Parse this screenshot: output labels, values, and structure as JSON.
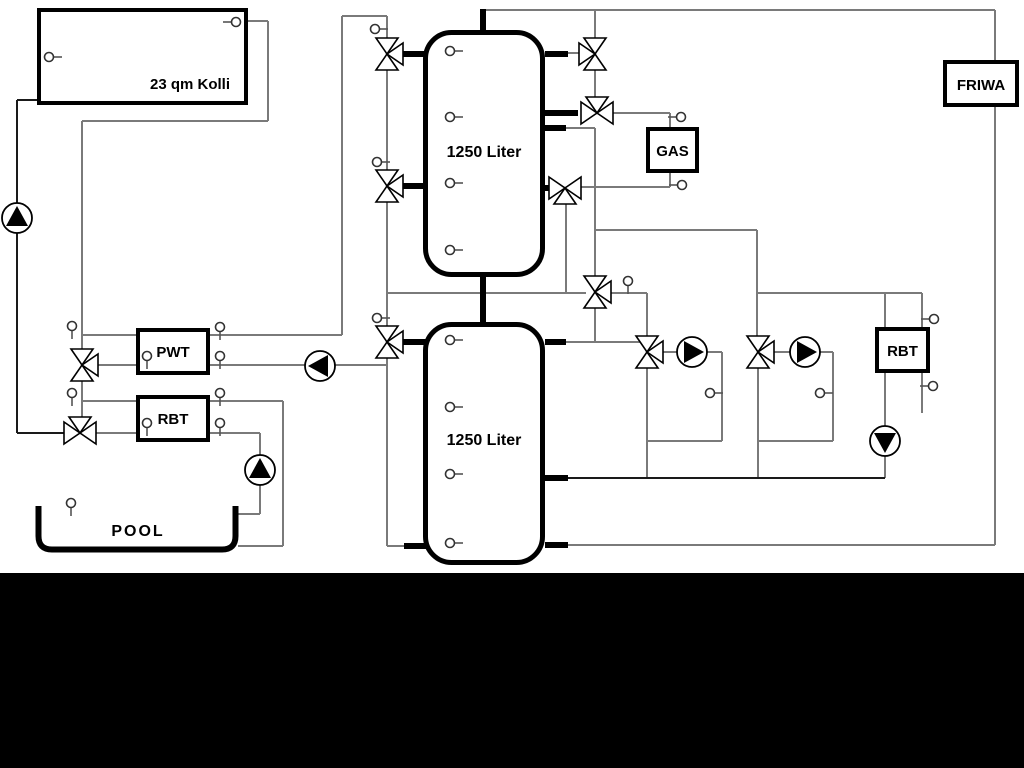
{
  "labels": {
    "collector": "23 qm Kolli",
    "buffer_tank_top": "1250 Liter",
    "buffer_tank_bottom": "1250 Liter",
    "pwt": "PWT",
    "rbt_left": "RBT",
    "pool": "POOL",
    "gas": "GAS",
    "friwa": "FRIWA",
    "rbt_right": "RBT"
  },
  "colors": {
    "background": "#ffffff",
    "pipe_gray": "#7a7a7a",
    "pipe_black": "#1a1a1a",
    "component_outline": "#000000",
    "footer_band": "#000000"
  }
}
